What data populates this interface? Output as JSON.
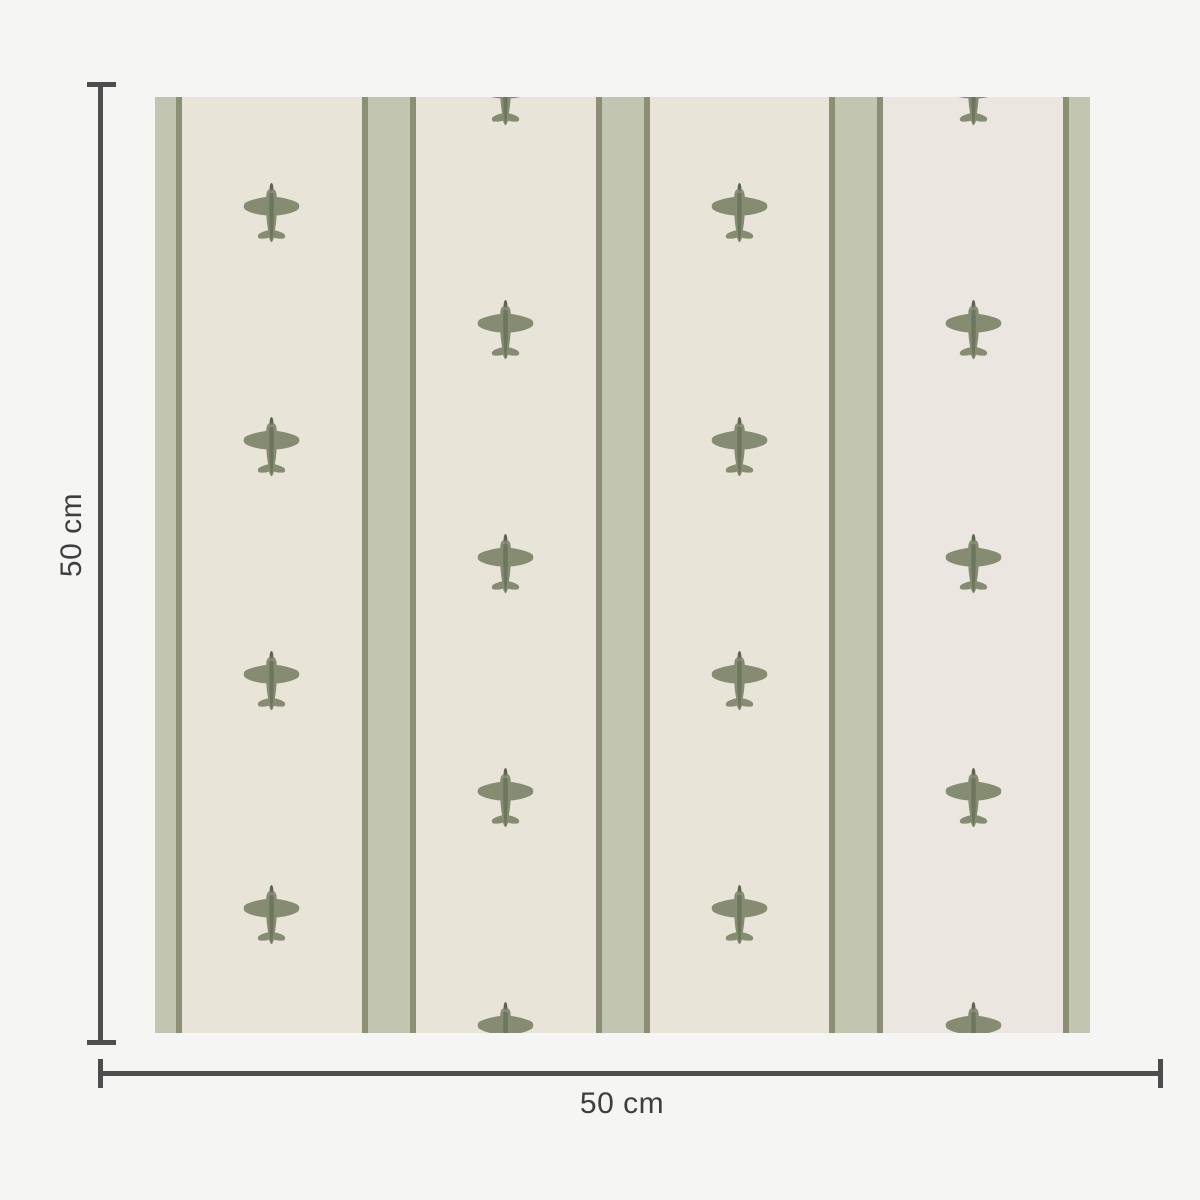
{
  "canvas": {
    "width": 1200,
    "height": 1200,
    "background": "#f5f5f4"
  },
  "dimensions": {
    "height_label": "50 cm",
    "width_label": "50 cm",
    "line_color": "#4d4d4d",
    "text_color": "#3e3e3e",
    "vertical": {
      "line_x": 98,
      "line_top": 84,
      "line_height": 961,
      "cap_x": 87,
      "cap_width": 29,
      "top_cap_y": 82,
      "bottom_cap_y": 1040,
      "label_center_x": 72,
      "label_center_y": 535
    },
    "horizontal": {
      "line_y": 1071,
      "line_left": 100,
      "line_width": 1063,
      "cap_y": 1059,
      "cap_height": 29,
      "left_cap_x": 98,
      "right_cap_x": 1158,
      "label_center_x": 622,
      "label_center_y": 1104
    },
    "line_thickness": 5
  },
  "swatch": {
    "x": 155,
    "y": 97,
    "width": 935,
    "height": 936,
    "base_color": "#e8e4d7",
    "alt_panel": {
      "x": 728,
      "width": 180,
      "color": "#ebe7e0"
    },
    "stripes": {
      "centers": [
        0,
        233.75,
        467.5,
        701.25,
        935
      ],
      "total_width": 54,
      "edge_width": 6,
      "sage_color": "#c2c5b0",
      "edge_color": "#8b9074"
    },
    "motif": {
      "name": "airplane",
      "width": 57,
      "height": 60,
      "body_color": "#858c72",
      "fuselage_color": "#6e755d",
      "spinner_color": "#5e654e",
      "columns": [
        {
          "x": 116.9,
          "rows": [
            116,
            350,
            584,
            818
          ]
        },
        {
          "x": 350.6,
          "rows": [
            -1,
            233,
            467,
            701,
            935
          ]
        },
        {
          "x": 584.4,
          "rows": [
            116,
            350,
            584,
            818
          ]
        },
        {
          "x": 818.1,
          "rows": [
            -1,
            233,
            467,
            701,
            935
          ]
        }
      ]
    }
  }
}
